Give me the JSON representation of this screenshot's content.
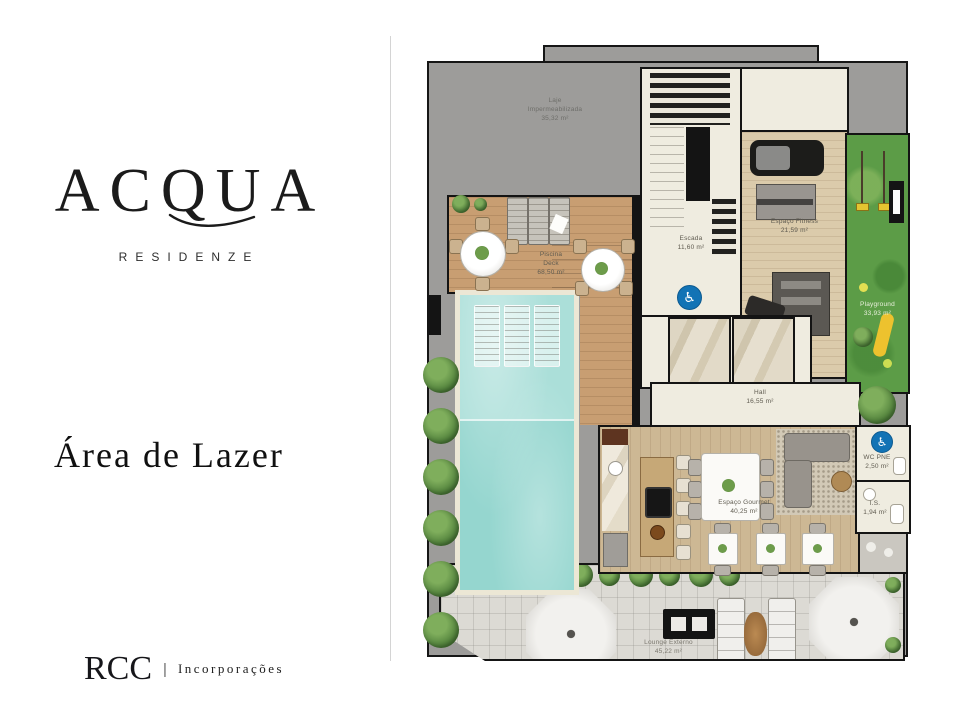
{
  "brand": {
    "name": "ACQUA",
    "subtitle": "RESIDENZE",
    "title": "Área de Lazer",
    "footer": {
      "company": "RCC",
      "separator": "|",
      "tagline": "Incorporações"
    }
  },
  "plan": {
    "rooms": {
      "laje": {
        "l1": "Laje",
        "l2": "Impermeabilizada",
        "area": "35,32 m²"
      },
      "escada": {
        "name": "Escada",
        "area": "11,60 m²"
      },
      "fitness": {
        "name": "Espaço Fitness",
        "area": "21,59 m²"
      },
      "playground": {
        "name": "Playground",
        "area": "33,93 m²"
      },
      "hall": {
        "name": "Hall",
        "area": "16,55 m²"
      },
      "deck": {
        "l1": "Piscina",
        "l2": "Deck",
        "area": "68,50 m²"
      },
      "gourmet": {
        "name": "Espaço Gourmet",
        "area": "40,25 m²"
      },
      "wc_pne": {
        "name": "WC PNE",
        "area": "2,50 m²"
      },
      "is": {
        "name": "I.S.",
        "area": "1,94 m²"
      },
      "lounge": {
        "name": "Lounge Externo",
        "area": "45,22 m²"
      }
    },
    "icons": {
      "accessibility": "♿"
    }
  },
  "colors": {
    "roof_gray": "#9d9c9a",
    "wood_deck": "#c89e72",
    "interior_wood": "#cdb894",
    "pool_water": "#9fd8d2",
    "grass": "#5c9c47",
    "pavement": "#dcdad4",
    "wall": "#141414",
    "accessibility_blue": "#1273b5"
  }
}
